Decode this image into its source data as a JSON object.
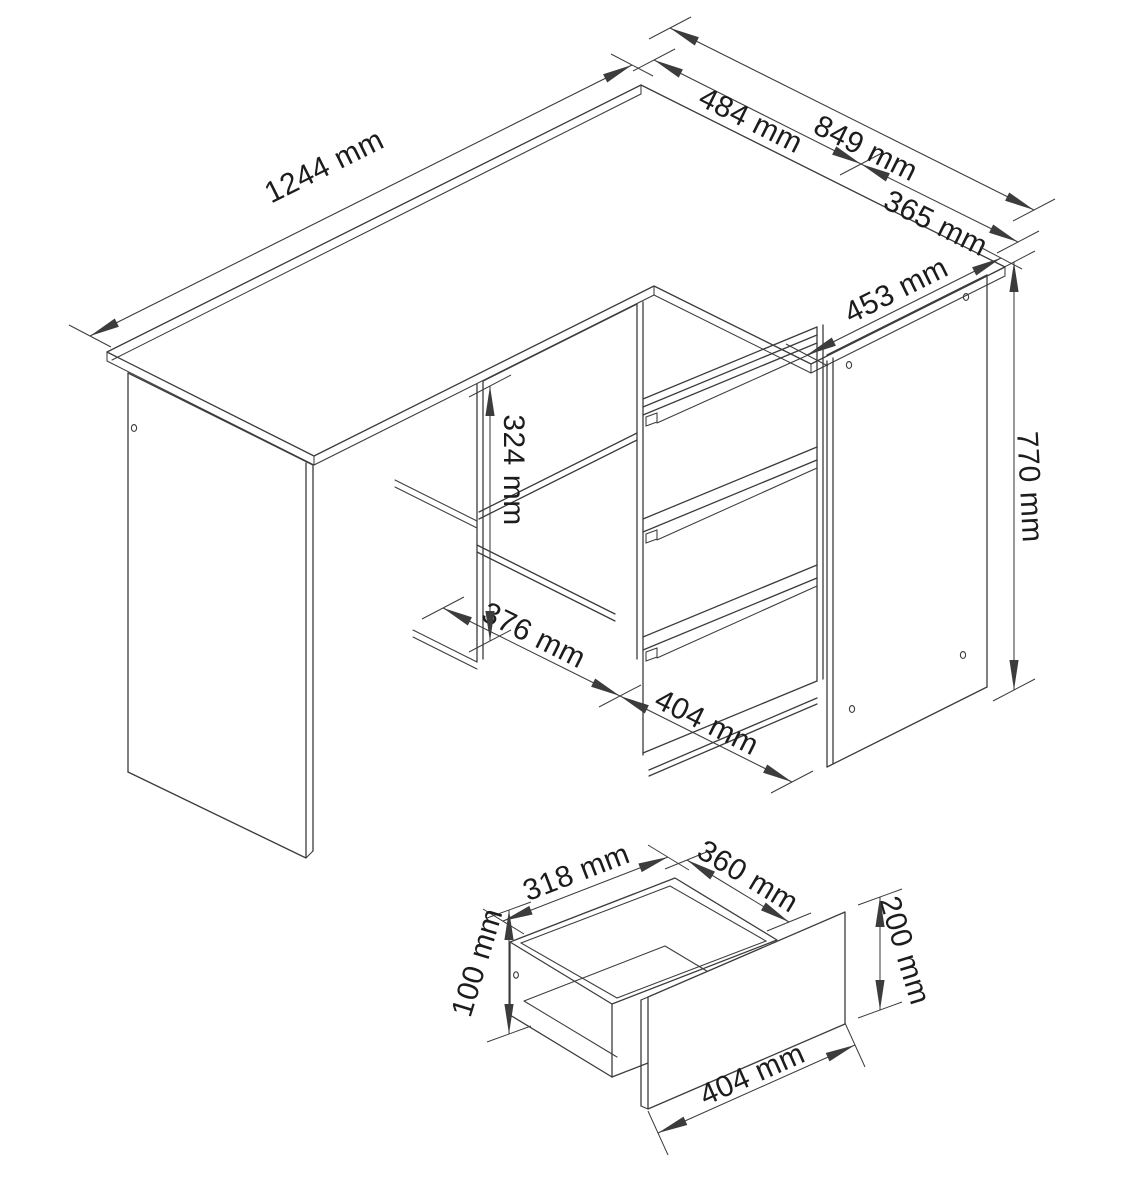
{
  "document": {
    "type": "furniture-dimension-diagram",
    "subject": "corner desk with drawer cabinet and drawer detail",
    "unit": "mm"
  },
  "colors": {
    "paper": "#ffffff",
    "ink": "#3c3c3c",
    "label": "#1c1c1c"
  },
  "main_view": {
    "name": "corner-desk-assembly-drawing",
    "dimensions": {
      "desk_length": "1244 mm",
      "desk_depth": "484 mm",
      "right_total_depth": "849 mm",
      "return_depth": "365 mm",
      "cabinet_top_depth": "453 mm",
      "niche_height": "324 mm",
      "cabinet_height": "770 mm",
      "niche_width": "376 mm",
      "drawer_front_width": "404 mm"
    }
  },
  "drawer_view": {
    "name": "drawer-detail-drawing",
    "dimensions": {
      "inner_width": "318 mm",
      "inner_depth": "360 mm",
      "box_height": "100 mm",
      "front_height": "200 mm",
      "front_width": "404 mm"
    }
  }
}
